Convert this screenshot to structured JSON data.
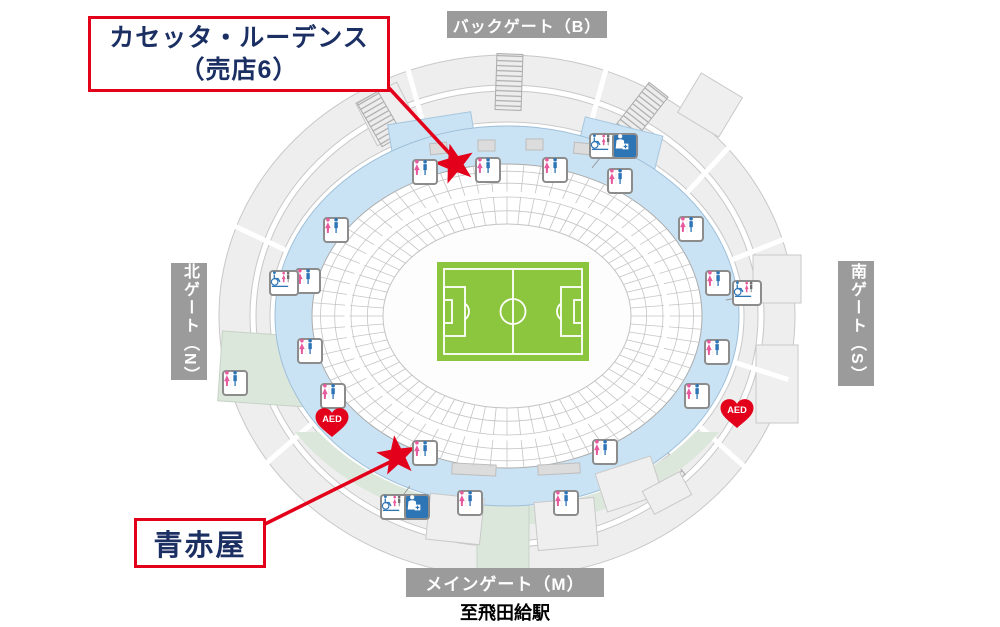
{
  "callouts": {
    "shop_top": {
      "line1": "カセッタ・ルーデンス",
      "line2": "（売店6）"
    },
    "shop_bottom": {
      "label": "青赤屋"
    }
  },
  "gates": {
    "back": "バックゲート（B）",
    "north": "北ゲート（N）",
    "south": "南ゲート（S）",
    "main": "メインゲート（M）"
  },
  "station_note": "至飛田給駅",
  "aed_label": "AED",
  "colors": {
    "accent_red": "#E3001B",
    "navy_text": "#1B2F63",
    "concourse_blue": "#C9E3F4",
    "pitch_green": "#8CC63F",
    "gate_gray": "#9B9B9B",
    "walkway_green": "#DCE7DC",
    "female_pink": "#E75A9E",
    "male_blue": "#2E75B6"
  },
  "map": {
    "stars": [
      {
        "x": 455,
        "y": 164,
        "rot": -15
      },
      {
        "x": 397,
        "y": 456,
        "rot": -8
      }
    ],
    "callout_lines": [
      {
        "x1": 389,
        "y1": 88,
        "x2": 451,
        "y2": 155
      },
      {
        "x1": 265,
        "y1": 524,
        "x2": 394,
        "y2": 460
      }
    ],
    "icons": [
      {
        "type": "restroom",
        "x": 425,
        "y": 172
      },
      {
        "type": "restroom",
        "x": 488,
        "y": 170
      },
      {
        "type": "restroom",
        "x": 555,
        "y": 170
      },
      {
        "type": "restroom",
        "x": 620,
        "y": 181
      },
      {
        "type": "restroom",
        "x": 691,
        "y": 229
      },
      {
        "type": "restroom",
        "x": 718,
        "y": 283
      },
      {
        "type": "restroom",
        "x": 717,
        "y": 352
      },
      {
        "type": "restroom",
        "x": 697,
        "y": 396
      },
      {
        "type": "restroom",
        "x": 605,
        "y": 452
      },
      {
        "type": "restroom",
        "x": 566,
        "y": 503
      },
      {
        "type": "restroom",
        "x": 470,
        "y": 503
      },
      {
        "type": "restroom",
        "x": 425,
        "y": 453
      },
      {
        "type": "restroom",
        "x": 333,
        "y": 396
      },
      {
        "type": "restroom",
        "x": 310,
        "y": 351
      },
      {
        "type": "restroom",
        "x": 308,
        "y": 281
      },
      {
        "type": "restroom",
        "x": 336,
        "y": 230
      },
      {
        "type": "restroom",
        "x": 235,
        "y": 383
      },
      {
        "type": "accessible",
        "x": 604,
        "y": 146
      },
      {
        "type": "accessible",
        "x": 747,
        "y": 293
      },
      {
        "type": "accessible",
        "x": 395,
        "y": 507
      },
      {
        "type": "accessible",
        "x": 284,
        "y": 283
      },
      {
        "type": "firstaid",
        "x": 625,
        "y": 146
      },
      {
        "type": "firstaid",
        "x": 417,
        "y": 507
      },
      {
        "type": "aed",
        "x": 313,
        "y": 406
      },
      {
        "type": "aed",
        "x": 718,
        "y": 397
      }
    ]
  }
}
